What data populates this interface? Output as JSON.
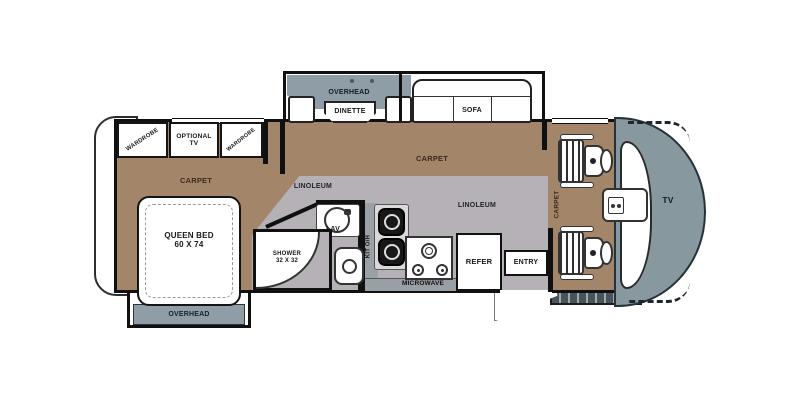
{
  "colors": {
    "carpet": "#a3866a",
    "linoleum": "#b6b1b7",
    "cabinet_gray": "#8f9ea6",
    "counter_gray": "#98a0a6",
    "front_cap": "#87989f",
    "skirt_dark": "#47545c",
    "wall": "#101010"
  },
  "bedroom": {
    "wardrobe_left": "WARDROBE",
    "optional_tv_line1": "OPTIONAL",
    "optional_tv_line2": "TV",
    "wardrobe_right": "WARDROBE",
    "carpet": "CARPET",
    "bed_line1": "QUEEN BED",
    "bed_line2": "60 X 74",
    "overhead": "OVERHEAD"
  },
  "slideout": {
    "overhead": "OVERHEAD",
    "dinette": "DINETTE",
    "sofa": "SOFA"
  },
  "living": {
    "carpet": "CARPET",
    "linoleum_bath": "LINOLEUM",
    "linoleum_galley": "LINOLEUM"
  },
  "bath": {
    "lav": "LAV",
    "shower_line1": "SHOWER",
    "shower_line2": "32 X 32"
  },
  "kitchen": {
    "kit_overhead": "KIT O/H",
    "microwave": "MICROWAVE",
    "refer": "REFER"
  },
  "entry": "ENTRY",
  "cab": {
    "carpet": "CARPET",
    "tv": "TV"
  }
}
